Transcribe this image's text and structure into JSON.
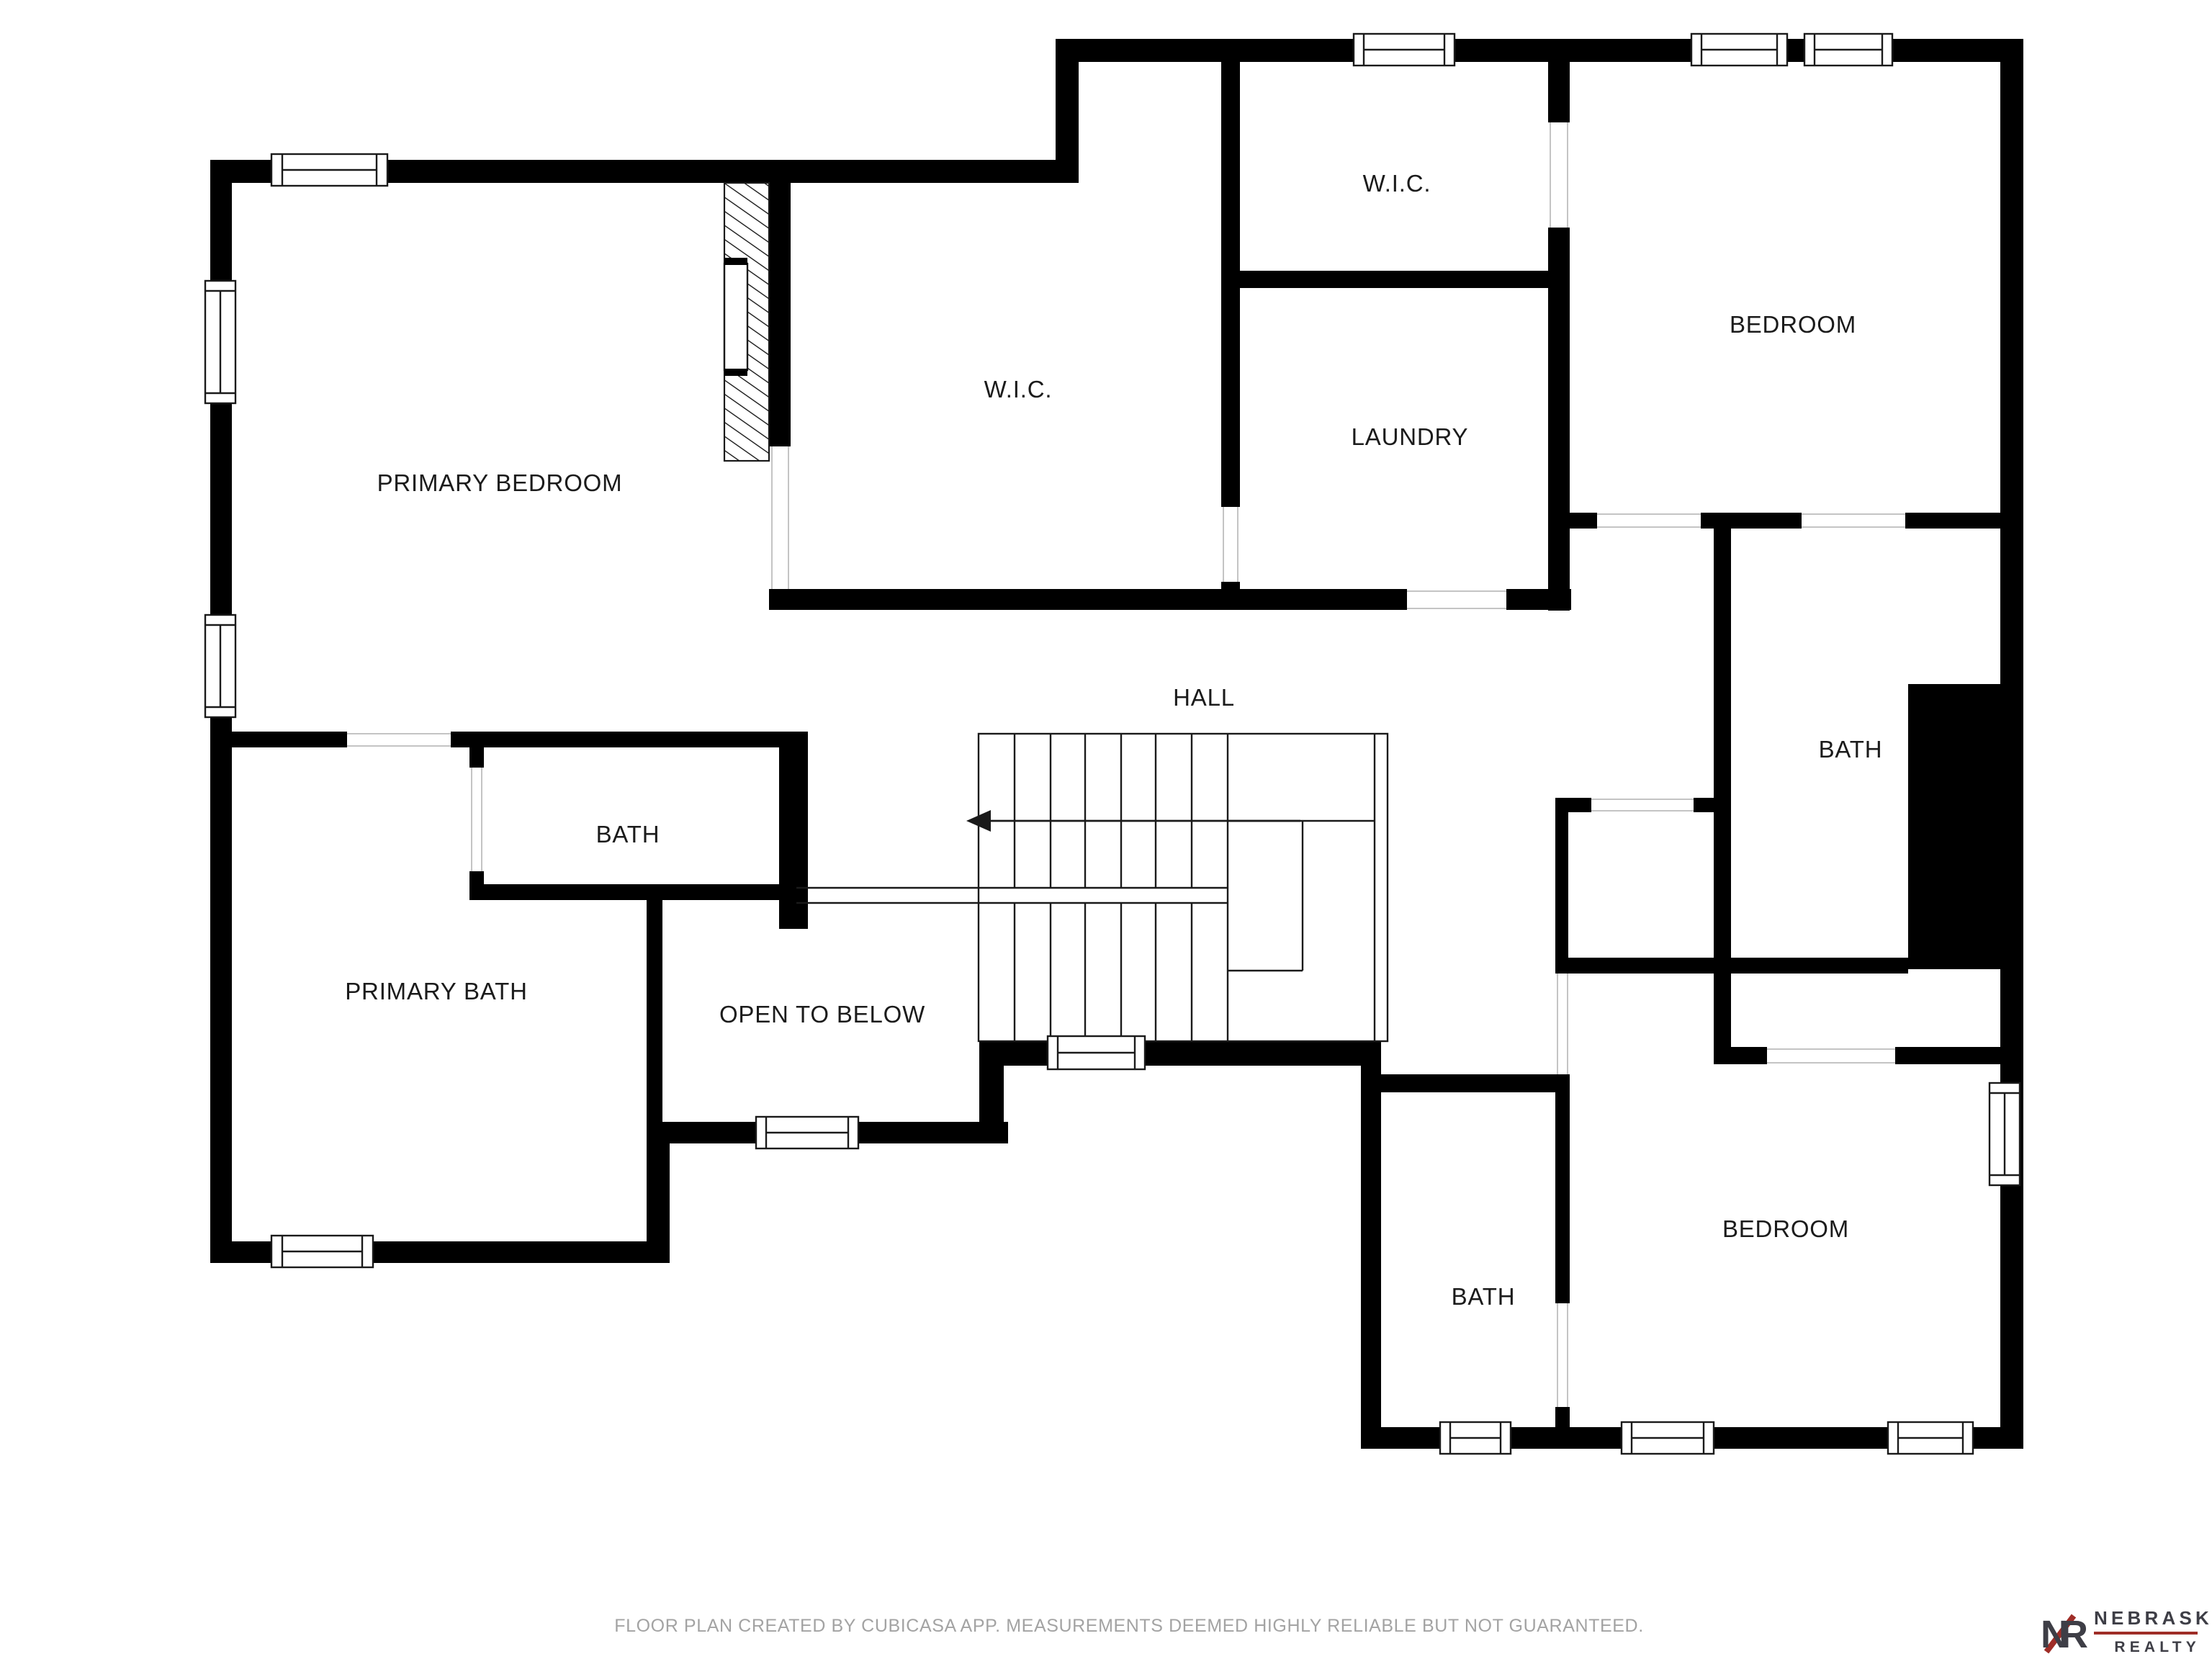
{
  "rooms": [
    {
      "id": "primary-bedroom",
      "label": "PRIMARY BEDROOM"
    },
    {
      "id": "wic-center",
      "label": "W.I.C."
    },
    {
      "id": "wic-top",
      "label": "W.I.C."
    },
    {
      "id": "laundry",
      "label": "LAUNDRY"
    },
    {
      "id": "bedroom-top-right",
      "label": "BEDROOM"
    },
    {
      "id": "hall",
      "label": "HALL"
    },
    {
      "id": "bath-left",
      "label": "BATH"
    },
    {
      "id": "bath-right",
      "label": "BATH"
    },
    {
      "id": "primary-bath",
      "label": "PRIMARY BATH"
    },
    {
      "id": "open-to-below",
      "label": "OPEN TO BELOW"
    },
    {
      "id": "bath-bottom",
      "label": "BATH"
    },
    {
      "id": "bedroom-bottom-right",
      "label": "BEDROOM"
    }
  ],
  "footer": {
    "disclaimer": "FLOOR PLAN CREATED BY CUBICASA APP. MEASUREMENTS DEEMED HIGHLY RELIABLE BUT NOT GUARANTEED."
  },
  "logo": {
    "monogram": "NR",
    "brand_name": "NEBRASKA",
    "brand_division": "REALTY"
  },
  "colors": {
    "wall": "#000000",
    "stair_line": "#1a1a1a",
    "jamb_line": "#c4c4c4",
    "room_label": "#1b1b1b",
    "disclaimer": "#a3a3a3",
    "logo_dark": "#3e3e46",
    "logo_red": "#9f2d27"
  }
}
